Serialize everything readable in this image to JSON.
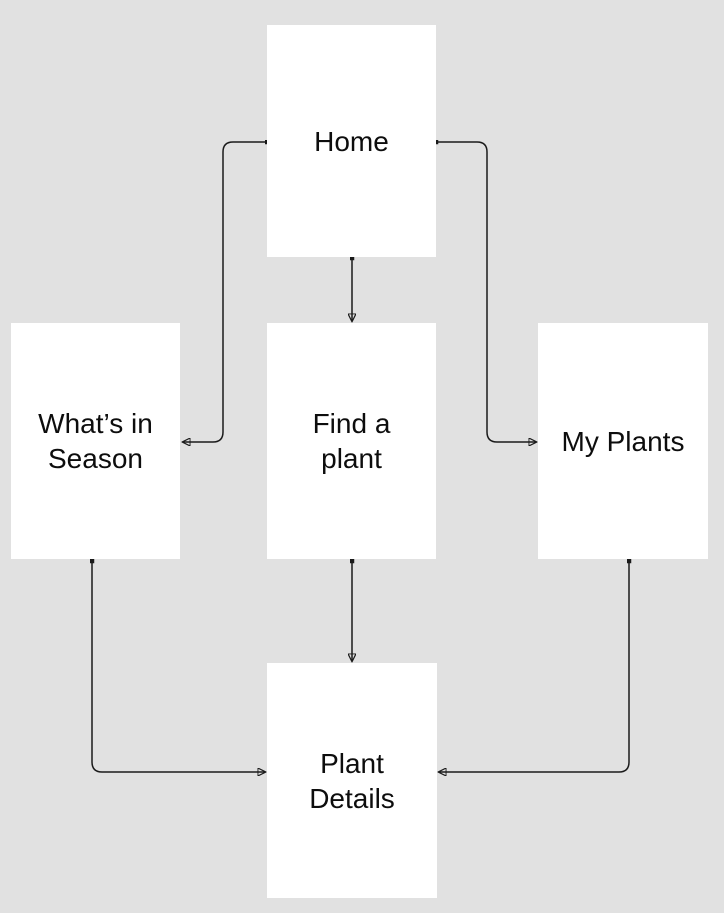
{
  "canvas": {
    "background_color": "#e1e1e1",
    "node_fill_color": "#ffffff",
    "connector_color": "#1a1a1a",
    "text_color": "#0d0d0d"
  },
  "nodes": {
    "home": {
      "label": "Home"
    },
    "whats_in_season": {
      "label": "What’s in\nSeason"
    },
    "find_a_plant": {
      "label": "Find a\nplant"
    },
    "my_plants": {
      "label": "My Plants"
    },
    "plant_details": {
      "label": "Plant\nDetails"
    }
  },
  "edges": [
    {
      "from": "Home",
      "to": "Find a plant"
    },
    {
      "from": "Home",
      "to": "What’s in Season"
    },
    {
      "from": "Home",
      "to": "My Plants"
    },
    {
      "from": "Find a plant",
      "to": "Plant Details"
    },
    {
      "from": "What’s in Season",
      "to": "Plant Details"
    },
    {
      "from": "My Plants",
      "to": "Plant Details"
    }
  ]
}
